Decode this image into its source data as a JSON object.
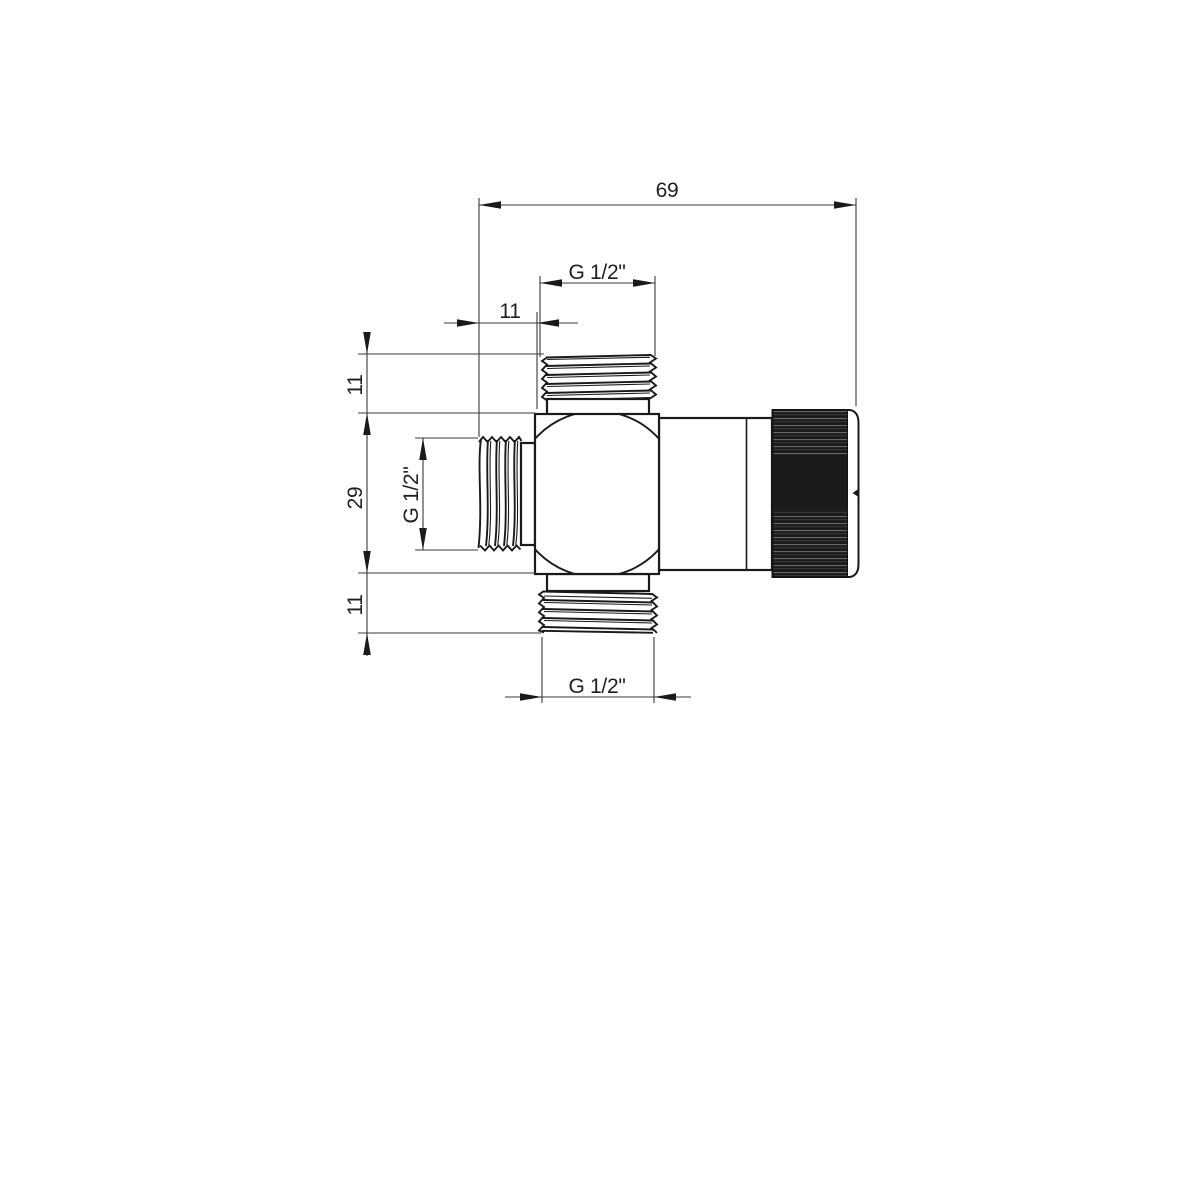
{
  "drawing": {
    "background": "#ffffff",
    "line_color": "#1a1a1a",
    "dim_color": "#3a3a3a",
    "knob_color": "#1b1b1d",
    "dims": {
      "overall_length": "69",
      "top_port_offset": "11",
      "thread_top": "G 1/2\"",
      "upper_height": "11",
      "body_height": "29",
      "lower_height": "11",
      "thread_left": "G 1/2\"",
      "thread_bottom": "G 1/2\""
    }
  }
}
